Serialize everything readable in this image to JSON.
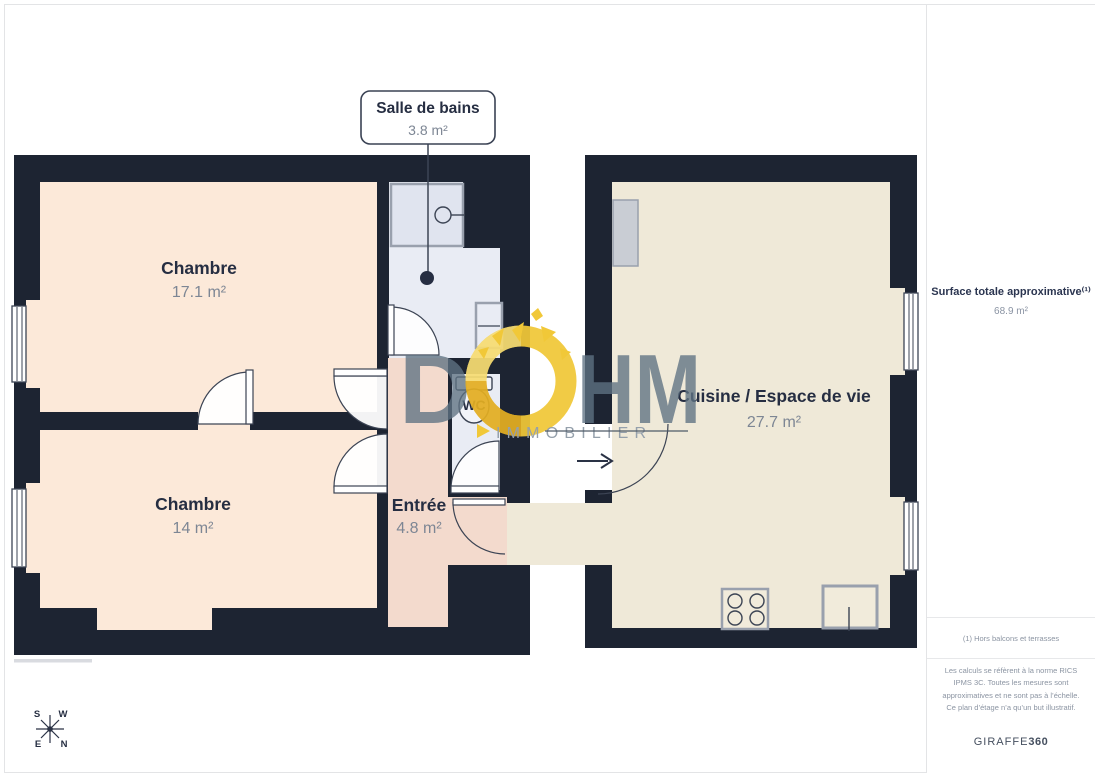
{
  "colors": {
    "wall": "#1d2432",
    "peach": "#fce9d9",
    "blue": "#e9ecf4",
    "shower": "#e0e4ef",
    "pink": "#f3dacd",
    "cream": "#efe9d8",
    "appliance": "#c9cdd4",
    "fixturefill": "#f2f4f9",
    "yellow": "#f1c838",
    "logoink": "#5f7383",
    "ink": "#262e42",
    "muted": "#7d8694",
    "line": "#3c4454",
    "fixframe": "#99a0ad"
  },
  "callout": {
    "title": "Salle de bains",
    "area": "3.8 m²"
  },
  "rooms": {
    "chambre1": {
      "name": "Chambre",
      "area": "17.1 m²"
    },
    "chambre2": {
      "name": "Chambre",
      "area": "14 m²"
    },
    "entree": {
      "name": "Entrée",
      "area": "4.8 m²"
    },
    "wc": {
      "name": "WC"
    },
    "cuisine": {
      "name": "Cuisine / Espace de vie",
      "area": "27.7 m²"
    }
  },
  "logo": {
    "left": "D",
    "right": "HM",
    "subtitle": "IMMOBILIER"
  },
  "sidebar": {
    "title": "Surface totale approximative⁽¹⁾",
    "total_area": "68.9 m²",
    "footnote": "(1) Hors balcons et terrasses",
    "legal": "Les calculs se réfèrent à la norme RICS IPMS 3C. Toutes les mesures sont approximatives et ne sont pas à l’échelle. Ce plan d’étage n’a qu’un but illustratif.",
    "brand": "GIRAFFE",
    "brand_suffix": "360"
  },
  "compass": {
    "top_left": "S",
    "top_right": "W",
    "bottom_left": "E",
    "bottom_right": "N"
  }
}
